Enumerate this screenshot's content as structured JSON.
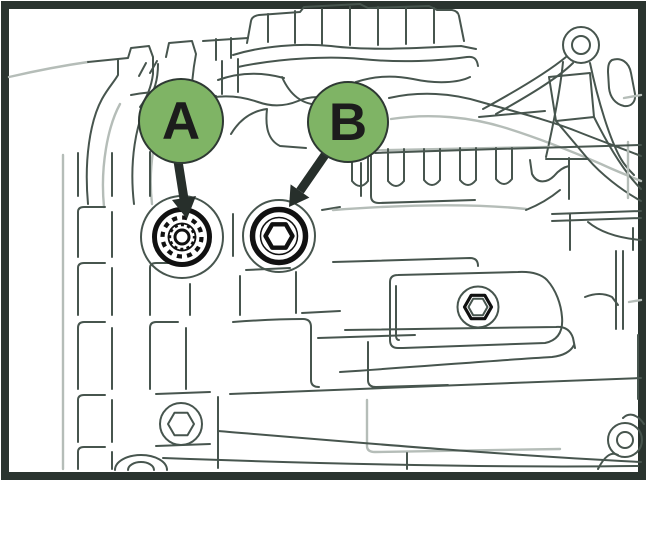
{
  "figure": {
    "description": "Technical line illustration of a gearbox housing side view showing two service plugs marked A (spline-socket plug) and B (hex-socket plug)",
    "background": "#ffffff"
  },
  "colors": {
    "frame": "#2a342f",
    "line_dark": "#47554e",
    "line_light": "#b5bdb8",
    "plug_ink": "#111111",
    "arrow": "#272f2b",
    "callout_fill": "#7fb465",
    "callout_stroke": "#2e3933",
    "callout_text": "#1c1c1c"
  },
  "callouts": [
    {
      "label": "A",
      "target": "spline-socket-plug"
    },
    {
      "label": "B",
      "target": "hex-socket-plug"
    }
  ]
}
